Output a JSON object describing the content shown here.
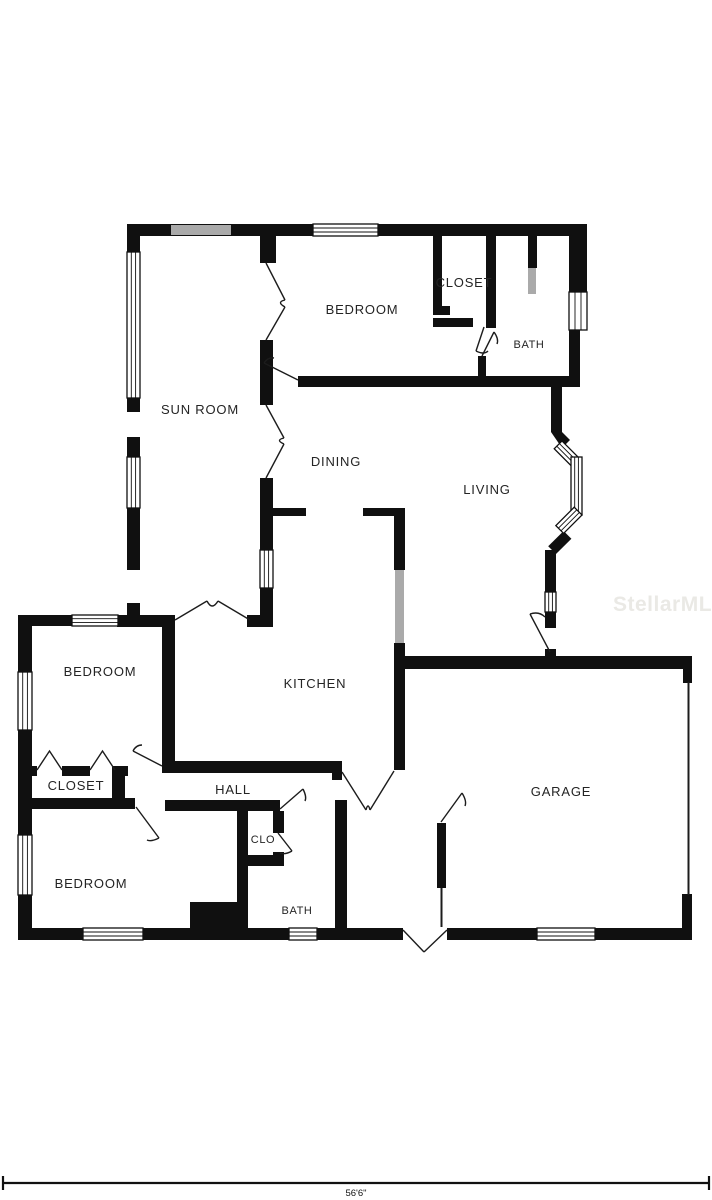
{
  "floor_plan": {
    "rooms": [
      {
        "id": "sun-room",
        "label": "SUN ROOM"
      },
      {
        "id": "bedroom-top",
        "label": "BEDROOM"
      },
      {
        "id": "closet-top",
        "label": "CLOSET"
      },
      {
        "id": "bath-top",
        "label": "BATH"
      },
      {
        "id": "dining",
        "label": "DINING"
      },
      {
        "id": "living",
        "label": "LIVING"
      },
      {
        "id": "kitchen",
        "label": "KITCHEN"
      },
      {
        "id": "bedroom-mid",
        "label": "BEDROOM"
      },
      {
        "id": "closet-mid",
        "label": "CLOSET"
      },
      {
        "id": "hall",
        "label": "HALL"
      },
      {
        "id": "clo",
        "label": "CLO"
      },
      {
        "id": "bedroom-bottom",
        "label": "BEDROOM"
      },
      {
        "id": "bath-bottom",
        "label": "BATH"
      },
      {
        "id": "garage",
        "label": "GARAGE"
      }
    ],
    "watermark": "StellarMLS",
    "dimension": {
      "width_label": "56'6\""
    },
    "colors": {
      "wall": "#101010",
      "gray_window": "#aaaaaa",
      "label": "#242424",
      "watermark": "#eae9e5"
    }
  }
}
